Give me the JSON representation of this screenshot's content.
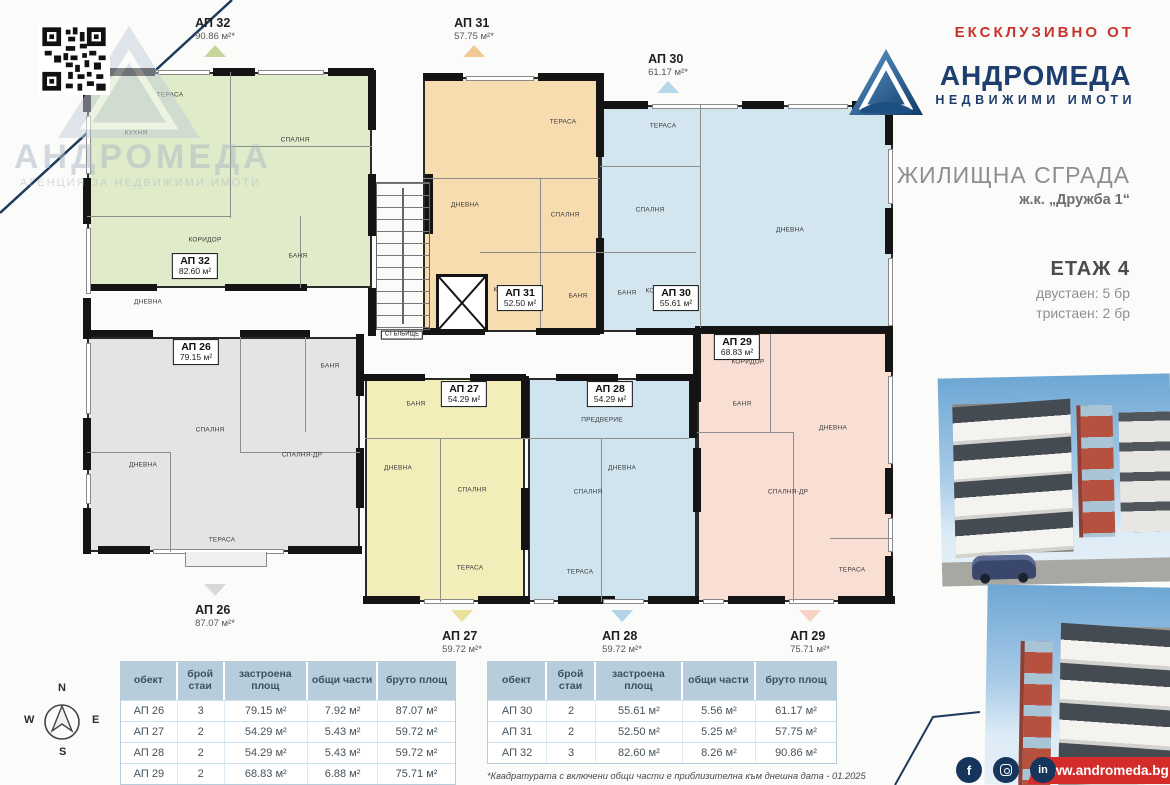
{
  "header": {
    "exclusive": "ЕКСКЛУЗИВНО ОТ",
    "brand": "АНДРОМЕДА",
    "brand_sub": "НЕДВИЖИМИ ИМОТИ",
    "brand_blue": "#1d3e6f",
    "accent_red": "#c8332f"
  },
  "watermark": {
    "brand": "АНДРОМЕДА",
    "sub": "АГЕНЦИЯ ЗА НЕДВИЖИМИ ИМОТИ"
  },
  "project": {
    "title": "ЖИЛИЩНА СГРАДА",
    "subtitle": "ж.к. „Дружба 1“",
    "floor": "ЕТАЖ 4",
    "lines": [
      "двустаен: 5 бр",
      "тристаен: 2 бр"
    ]
  },
  "floorplan": {
    "apartments": [
      {
        "name": "ap-32",
        "fill": "#e0ebc9",
        "x": 87,
        "y": 72,
        "w": 285,
        "h": 216
      },
      {
        "name": "ap-31",
        "fill": "#f6dcae",
        "x": 423,
        "y": 77,
        "w": 177,
        "h": 255
      },
      {
        "name": "ap-30",
        "fill": "#d3e6f0",
        "x": 600,
        "y": 105,
        "w": 293,
        "h": 227
      },
      {
        "name": "ap-26",
        "fill": "#e4e4e2",
        "x": 87,
        "y": 337,
        "w": 273,
        "h": 215
      },
      {
        "name": "ap-27",
        "fill": "#f3edba",
        "x": 365,
        "y": 378,
        "w": 160,
        "h": 224
      },
      {
        "name": "ap-28",
        "fill": "#cfe4ee",
        "x": 528,
        "y": 378,
        "w": 169,
        "h": 224
      },
      {
        "name": "ap-29",
        "fill": "#f9dfd3",
        "x": 697,
        "y": 332,
        "w": 196,
        "h": 270
      }
    ],
    "walls": [
      [
        100,
        68,
        55,
        8
      ],
      [
        213,
        68,
        42,
        8
      ],
      [
        328,
        68,
        46,
        8
      ],
      [
        423,
        73,
        40,
        8
      ],
      [
        538,
        73,
        64,
        8
      ],
      [
        600,
        101,
        48,
        8
      ],
      [
        742,
        101,
        42,
        8
      ],
      [
        852,
        101,
        43,
        8
      ],
      [
        83,
        68,
        8,
        44
      ],
      [
        83,
        178,
        8,
        46
      ],
      [
        83,
        298,
        8,
        41
      ],
      [
        83,
        418,
        8,
        52
      ],
      [
        83,
        508,
        8,
        46
      ],
      [
        885,
        101,
        8,
        44
      ],
      [
        885,
        208,
        8,
        46
      ],
      [
        885,
        330,
        8,
        42
      ],
      [
        885,
        468,
        8,
        46
      ],
      [
        885,
        556,
        8,
        48
      ],
      [
        98,
        546,
        52,
        8
      ],
      [
        288,
        546,
        74,
        8
      ],
      [
        363,
        596,
        57,
        8
      ],
      [
        478,
        596,
        52,
        8
      ],
      [
        558,
        596,
        57,
        8
      ],
      [
        648,
        596,
        51,
        8
      ],
      [
        728,
        596,
        57,
        8
      ],
      [
        838,
        596,
        57,
        8
      ],
      [
        368,
        70,
        8,
        60
      ],
      [
        368,
        174,
        8,
        62
      ],
      [
        368,
        288,
        8,
        48
      ],
      [
        425,
        174,
        8,
        60
      ],
      [
        596,
        73,
        8,
        84
      ],
      [
        596,
        238,
        8,
        96
      ],
      [
        693,
        330,
        8,
        72
      ],
      [
        693,
        448,
        8,
        64
      ],
      [
        521,
        376,
        8,
        62
      ],
      [
        521,
        488,
        8,
        62
      ],
      [
        689,
        376,
        8,
        62
      ],
      [
        356,
        334,
        8,
        62
      ],
      [
        356,
        448,
        8,
        60
      ],
      [
        87,
        284,
        70,
        7
      ],
      [
        225,
        284,
        82,
        7
      ],
      [
        87,
        330,
        66,
        7
      ],
      [
        240,
        330,
        70,
        7
      ],
      [
        423,
        328,
        62,
        7
      ],
      [
        536,
        328,
        64,
        7
      ],
      [
        636,
        328,
        60,
        7
      ],
      [
        363,
        374,
        62,
        7
      ],
      [
        470,
        374,
        56,
        7
      ],
      [
        556,
        374,
        62,
        7
      ],
      [
        636,
        374,
        57,
        7
      ],
      [
        695,
        326,
        198,
        8
      ]
    ],
    "windows": [
      [
        158,
        70,
        52,
        5
      ],
      [
        258,
        70,
        66,
        5
      ],
      [
        466,
        76,
        68,
        5
      ],
      [
        652,
        104,
        86,
        5
      ],
      [
        788,
        104,
        60,
        5
      ],
      [
        86,
        116,
        5,
        58
      ],
      [
        86,
        228,
        5,
        66
      ],
      [
        86,
        343,
        5,
        71
      ],
      [
        86,
        474,
        5,
        30
      ],
      [
        888,
        149,
        5,
        55
      ],
      [
        888,
        258,
        5,
        68
      ],
      [
        888,
        376,
        5,
        88
      ],
      [
        888,
        518,
        5,
        34
      ],
      [
        153,
        549,
        131,
        5
      ],
      [
        424,
        599,
        50,
        5
      ],
      [
        534,
        599,
        20,
        5
      ],
      [
        603,
        599,
        41,
        5
      ],
      [
        703,
        599,
        21,
        5
      ],
      [
        789,
        599,
        45,
        5
      ]
    ],
    "partitions": [
      [
        230,
        72,
        1,
        146
      ],
      [
        230,
        146,
        142,
        1
      ],
      [
        87,
        216,
        143,
        1
      ],
      [
        300,
        216,
        1,
        72
      ],
      [
        423,
        178,
        177,
        1
      ],
      [
        540,
        178,
        1,
        150
      ],
      [
        480,
        252,
        120,
        1
      ],
      [
        700,
        105,
        1,
        223
      ],
      [
        600,
        166,
        100,
        1
      ],
      [
        600,
        252,
        96,
        1
      ],
      [
        240,
        337,
        1,
        115
      ],
      [
        170,
        452,
        1,
        100
      ],
      [
        87,
        452,
        83,
        1
      ],
      [
        240,
        452,
        120,
        1
      ],
      [
        305,
        337,
        1,
        95
      ],
      [
        365,
        438,
        163,
        1
      ],
      [
        440,
        438,
        1,
        164
      ],
      [
        528,
        438,
        161,
        1
      ],
      [
        601,
        438,
        1,
        164
      ],
      [
        770,
        334,
        1,
        98
      ],
      [
        697,
        432,
        96,
        1
      ],
      [
        793,
        432,
        1,
        170
      ],
      [
        830,
        538,
        63,
        1
      ]
    ],
    "rooms": [
      [
        "ТЕРАСА",
        170,
        95
      ],
      [
        "КУХНЯ",
        136,
        133
      ],
      [
        "СПАЛНЯ",
        295,
        140
      ],
      [
        "КОРИДОР",
        205,
        240
      ],
      [
        "БАНЯ",
        298,
        256
      ],
      [
        "ДНЕВНА",
        148,
        302
      ],
      [
        "ТЕРАСА",
        563,
        122
      ],
      [
        "ДНЕВНА",
        465,
        205
      ],
      [
        "СПАЛНЯ",
        565,
        215
      ],
      [
        "КОРИДОР",
        510,
        290
      ],
      [
        "БАНЯ",
        578,
        296
      ],
      [
        "ТЕРАСА",
        663,
        126
      ],
      [
        "СПАЛНЯ",
        650,
        210
      ],
      [
        "ДНЕВНА",
        790,
        230
      ],
      [
        "КОРИДОР",
        662,
        291
      ],
      [
        "БАНЯ",
        627,
        293
      ],
      [
        "ДНЕВНА",
        143,
        465
      ],
      [
        "СПАЛНЯ",
        210,
        430
      ],
      [
        "СПАЛНЯ-ДР",
        302,
        455
      ],
      [
        "ТЕРАСА",
        222,
        540
      ],
      [
        "БАНЯ",
        330,
        366
      ],
      [
        "БАНЯ",
        416,
        404
      ],
      [
        "ДНЕВНА",
        398,
        468
      ],
      [
        "СПАЛНЯ",
        472,
        490
      ],
      [
        "ТЕРАСА",
        470,
        568
      ],
      [
        "ПРЕДВЕРИЕ",
        602,
        420
      ],
      [
        "ДНЕВНА",
        622,
        468
      ],
      [
        "СПАЛНЯ",
        588,
        492
      ],
      [
        "ТЕРАСА",
        580,
        572
      ],
      [
        "КОРИДОР",
        748,
        362
      ],
      [
        "БАНЯ",
        742,
        404
      ],
      [
        "ДНЕВНА",
        833,
        428
      ],
      [
        "СПАЛНЯ-ДР",
        788,
        492
      ],
      [
        "ТЕРАСА",
        852,
        570
      ]
    ],
    "tags": [
      [
        "АП 32",
        "82.60 м²",
        195,
        266
      ],
      [
        "АП 26",
        "79.15 м²",
        196,
        352
      ],
      [
        "АП 31",
        "52.50 м²",
        520,
        298
      ],
      [
        "АП 30",
        "55.61 м²",
        676,
        298
      ],
      [
        "АП 29",
        "68.83 м²",
        737,
        347
      ],
      [
        "АП 27",
        "54.29 м²",
        464,
        394
      ],
      [
        "АП 28",
        "54.29 м²",
        610,
        394
      ],
      [
        "СТЪЛБИЩЕ",
        "",
        402,
        335
      ]
    ],
    "callouts": [
      [
        "АП 32",
        "90.86 м²*",
        215,
        16,
        "top",
        "#c6d79c"
      ],
      [
        "АП 31",
        "57.75 м²*",
        474,
        16,
        "top",
        "#f2c993"
      ],
      [
        "АП 30",
        "61.17 м²*",
        668,
        52,
        "top",
        "#b6d7e7"
      ],
      [
        "АП 26",
        "87.07 м²*",
        215,
        584,
        "bottom",
        "#d9d9d9"
      ],
      [
        "АП 27",
        "59.72 м²*",
        462,
        610,
        "bottom",
        "#e9e09c"
      ],
      [
        "АП 28",
        "59.72 м²*",
        622,
        610,
        "bottom",
        "#b2d4e5"
      ],
      [
        "АП 29",
        "75.71 м²*",
        810,
        610,
        "bottom",
        "#f6d3c3"
      ]
    ]
  },
  "tables": [
    {
      "headers": [
        "обект",
        "брой стаи",
        "застроена площ",
        "общи части",
        "бруто площ"
      ],
      "rows": [
        [
          "АП 26",
          "3",
          "79.15 м²",
          "7.92 м²",
          "87.07 м²"
        ],
        [
          "АП 27",
          "2",
          "54.29 м²",
          "5.43 м²",
          "59.72 м²"
        ],
        [
          "АП 28",
          "2",
          "54.29 м²",
          "5.43 м²",
          "59.72 м²"
        ],
        [
          "АП 29",
          "2",
          "68.83 м²",
          "6.88 м²",
          "75.71 м²"
        ]
      ]
    },
    {
      "headers": [
        "обект",
        "брой стаи",
        "застроена площ",
        "общи части",
        "бруто площ"
      ],
      "rows": [
        [
          "АП 30",
          "2",
          "55.61 м²",
          "5.56 м²",
          "61.17 м²"
        ],
        [
          "АП 31",
          "2",
          "52.50 м²",
          "5.25 м²",
          "57.75 м²"
        ],
        [
          "АП 32",
          "3",
          "82.60 м²",
          "8.26 м²",
          "90.86 м²"
        ]
      ]
    }
  ],
  "footnote": "*Квадратурата с включени общи части е приблизителна към днешна дата - 01.2025",
  "compass": {
    "n": "N",
    "e": "E",
    "s": "S",
    "w": "W"
  },
  "footer": {
    "website": "www.andromeda.bg",
    "social": [
      "facebook",
      "instagram",
      "linkedin"
    ]
  }
}
